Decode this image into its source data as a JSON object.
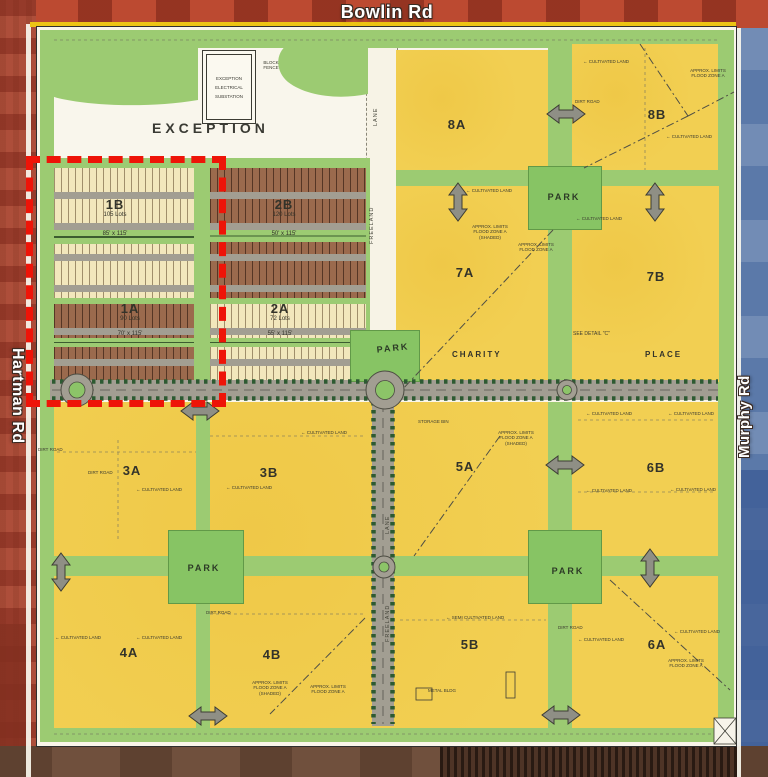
{
  "map": {
    "roads": {
      "bowlin": "Bowlin Rd",
      "hartman": "Hartman Rd",
      "murphy": "Murphy Rd",
      "charity": "CHARITY",
      "place": "PLACE",
      "freeland": "FREELAND",
      "lane": "LANE"
    },
    "labels": {
      "exception": "EXCEPTION",
      "park": "PARK",
      "see_detail": "SEE DETAIL \"C\""
    },
    "substation": {
      "line1": "EXCEPTION",
      "line2": "ELECTRICAL",
      "line3": "SUBSTATION",
      "fence_note": "BLOCK FENCE"
    },
    "parcels": {
      "p1B": {
        "id": "1B",
        "lots": "105 Lots",
        "size": "85' x 115'"
      },
      "p1A": {
        "id": "1A",
        "lots": "90 Lots",
        "size": "70' x 115'"
      },
      "p2B": {
        "id": "2B",
        "lots": "120 Lots",
        "size": "50' x 115'"
      },
      "p2A": {
        "id": "2A",
        "lots": "72 Lots",
        "size": "55' x 115'"
      },
      "p3A": {
        "id": "3A"
      },
      "p3B": {
        "id": "3B"
      },
      "p4A": {
        "id": "4A"
      },
      "p4B": {
        "id": "4B"
      },
      "p5A": {
        "id": "5A"
      },
      "p5B": {
        "id": "5B"
      },
      "p6A": {
        "id": "6A"
      },
      "p6B": {
        "id": "6B"
      },
      "p7A": {
        "id": "7A"
      },
      "p7B": {
        "id": "7B"
      },
      "p8A": {
        "id": "8A"
      },
      "p8B": {
        "id": "8B"
      }
    },
    "annotations": {
      "cultivated": "← CULTIVATED LAND",
      "semi_cultivated": "← SEMI CULTIVATED LAND",
      "dirt_road": "DIRT ROAD",
      "flood_zone": "APPROX. LIMITS FLOOD ZONE A",
      "flood_zone_shaded": "APPROX. LIMITS FLOOD ZONE A (SHADED)",
      "storage_bin": "STORAGE BIN",
      "metal_bldg": "METAL BLDG"
    },
    "colors": {
      "parcel_yellow": "#f2cf52",
      "open_green": "#9ccb72",
      "park_green": "#87c464",
      "lot_brown": "#9b6a4d",
      "lot_cream": "#f2e7bc",
      "road_grey": "#a29e92",
      "tree_green": "#2d5a32",
      "highlight_red": "#ee1408"
    }
  }
}
